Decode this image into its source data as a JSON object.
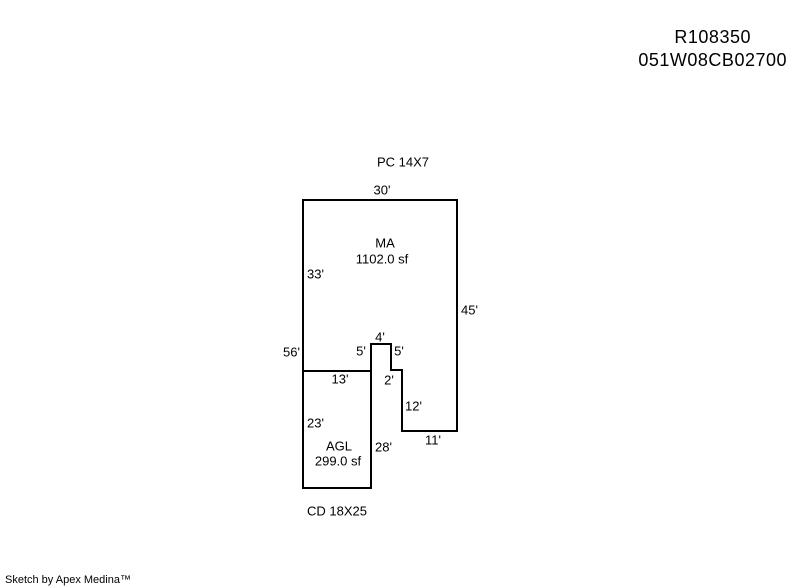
{
  "title": {
    "line1": "R108350",
    "line2": "051W08CB02700"
  },
  "sketch": {
    "attachments": {
      "pc": "PC 14X7",
      "cd": "CD 18X25"
    },
    "areas": {
      "ma": {
        "code": "MA",
        "area": "1102.0 sf"
      },
      "agl": {
        "code": "AGL",
        "area": "299.0 sf"
      }
    },
    "dimensions": {
      "top": "30'",
      "left_upper": "33'",
      "right": "45'",
      "left_total": "56'",
      "notch_top": "4'",
      "notch_left": "5'",
      "notch_right": "5'",
      "divider": "13'",
      "step": "2'",
      "step_right": "12'",
      "agl_left": "23'",
      "agl_right": "28'",
      "bottom_right": "11'"
    },
    "colors": {
      "line": "#000000",
      "background": "#ffffff"
    }
  },
  "footer": {
    "attribution": "Sketch by Apex Medina™"
  }
}
